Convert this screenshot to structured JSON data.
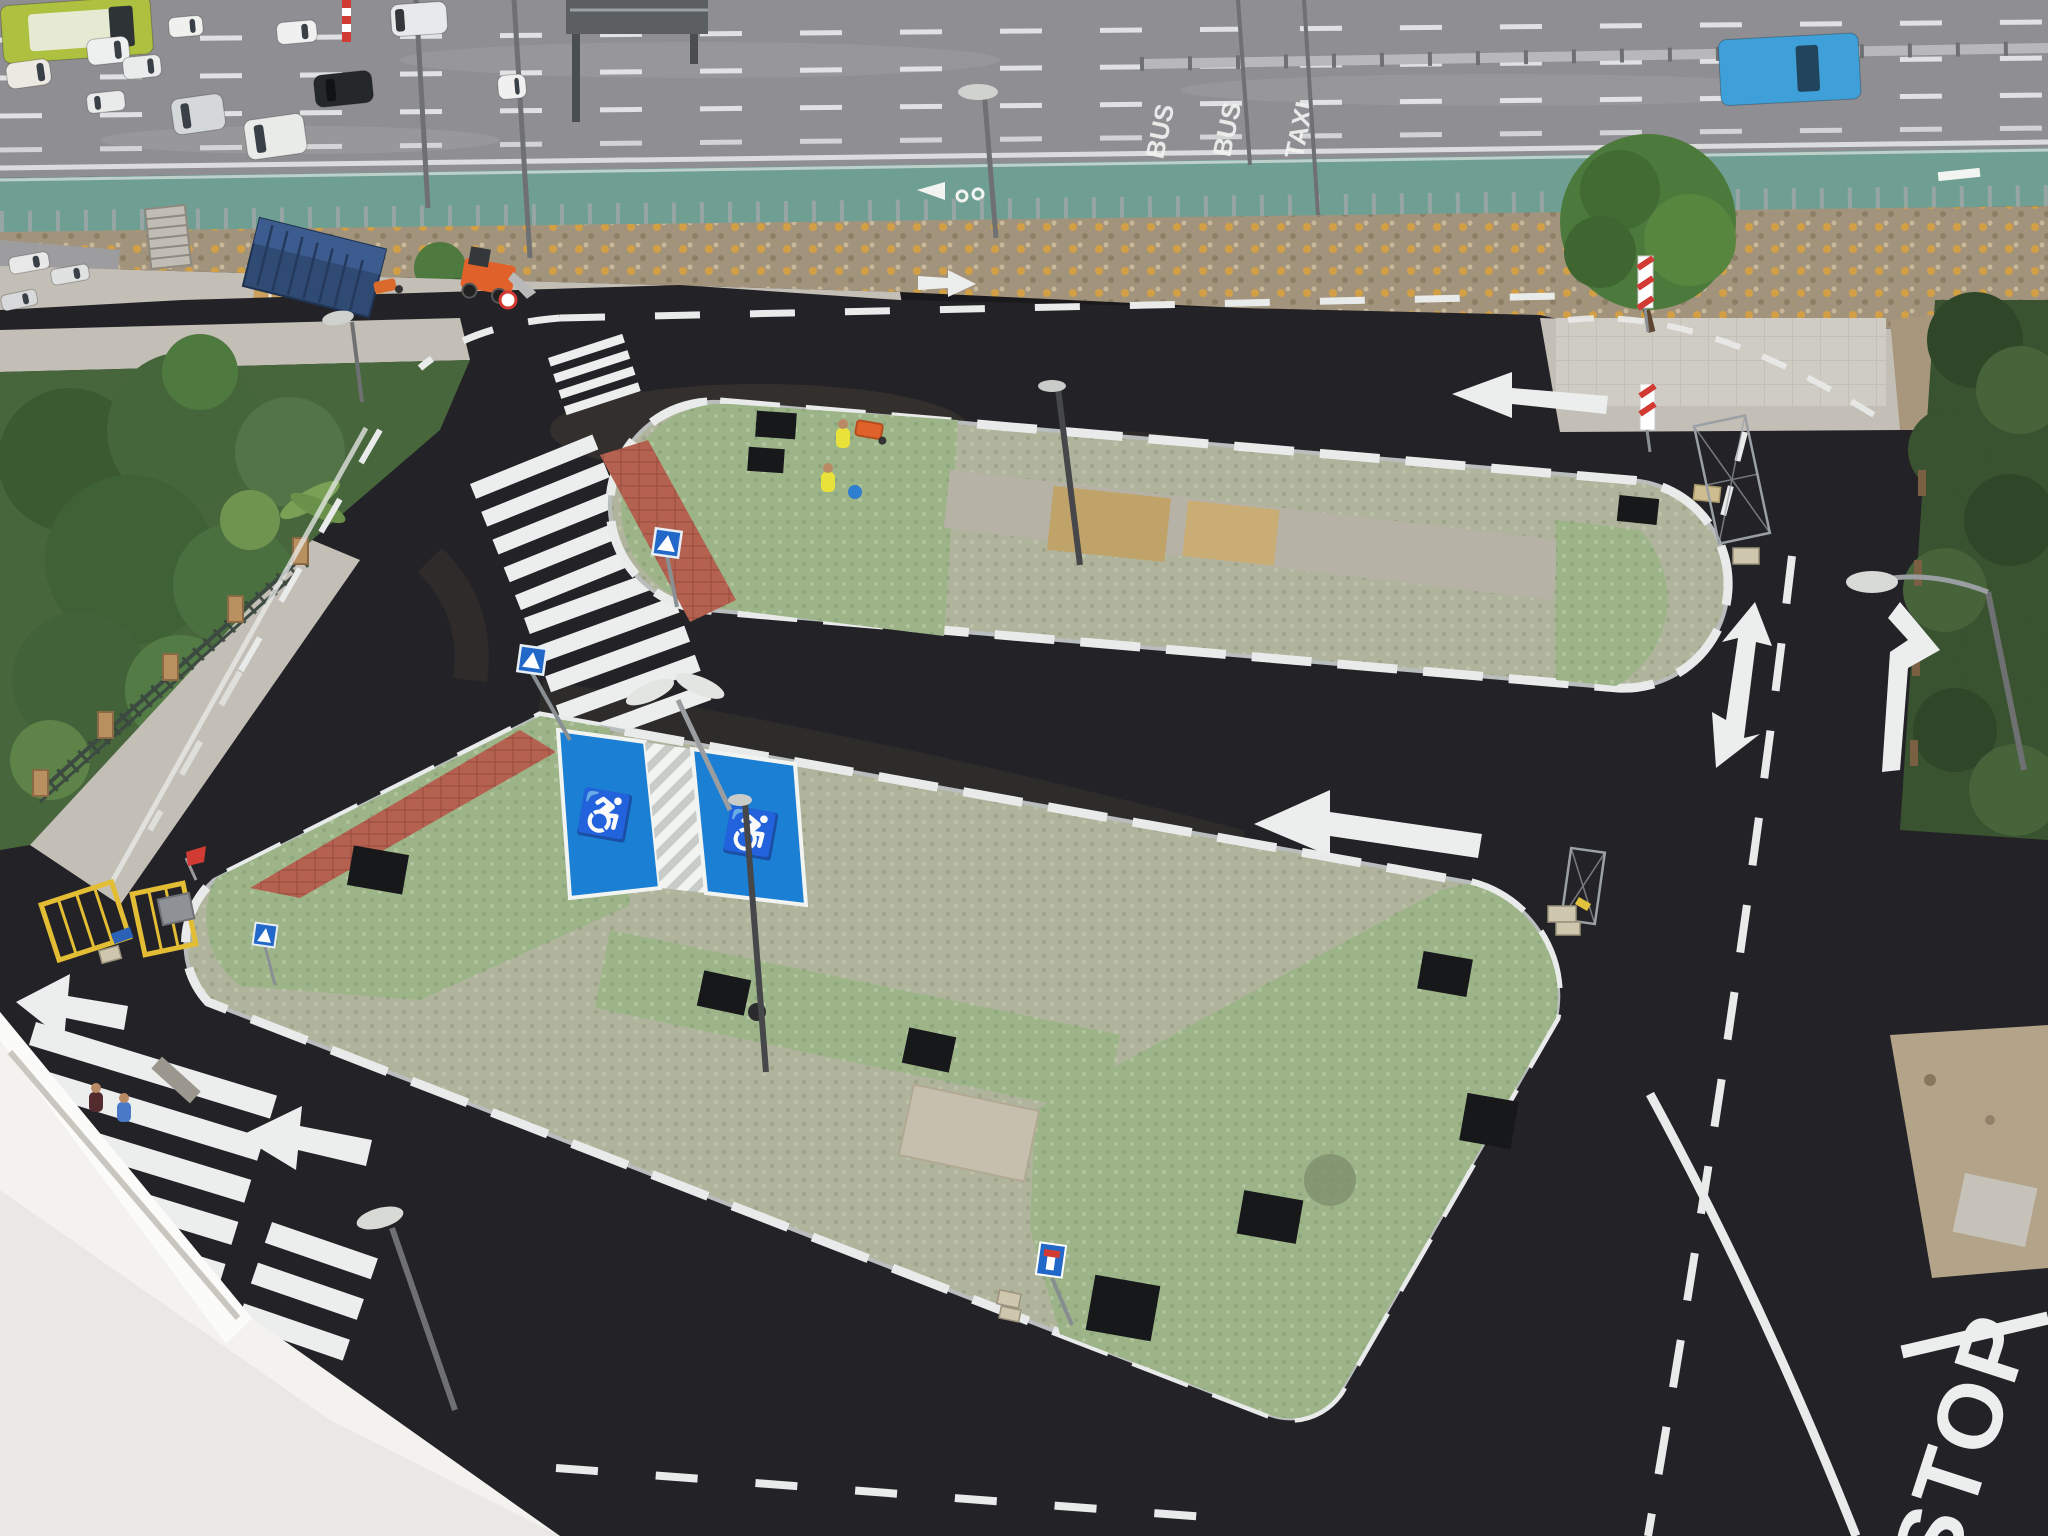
{
  "scene": {
    "setting": "aerial view of a newly paved parking area with two landscaped parking islands beside a multi-lane highway",
    "conditions": "daytime, overcast"
  },
  "road_paint_text": {
    "bus_1": "BUS",
    "bus_2": "BUS",
    "taxi": "TAXI",
    "stop": "STOP"
  },
  "icons": {
    "wheelchair": "♿"
  },
  "colors": {
    "highway": "#8f8f93",
    "bike_lane": "#6f9f92",
    "wall": "#a2937c",
    "sidewalk": "#c3bfb6",
    "concrete_old": "#b7b3aa",
    "asphalt": "#232327",
    "island_paver": "#b0b49c",
    "island_green": "#9db489",
    "spine_concrete": "#b7b2a6",
    "tan_panel": "#bfa368",
    "red_tile": "#b4614f",
    "pit_black": "#17181a",
    "curb_white": "#e9ebea",
    "handicap_blue": "#1b7fd4",
    "sign_blue": "#2268c8",
    "red_sign": "#d13b34",
    "garden_lawn": "#47663c",
    "hedge": "#39522f",
    "building": "#f3f2ef",
    "container": "#2f4a73",
    "machine_orange": "#e0622a",
    "barrier_yellow": "#e3bd34",
    "dirt": "#b3a489",
    "vest_hivis": "#e8e23a"
  },
  "vehicles": [
    {
      "name": "bus-green",
      "x": 0,
      "y": 6,
      "w": 150,
      "h": 58,
      "a": -4,
      "body": "#aec03f",
      "glass": "#2e3436",
      "win": 0.72,
      "roof": "#e6ead2"
    },
    {
      "name": "van-white-yellow-stripe",
      "x": 5,
      "y": 64,
      "w": 44,
      "h": 26,
      "a": -8,
      "body": "#ece9e2",
      "win": 0.7
    },
    {
      "name": "car-white-1",
      "x": 86,
      "y": 40,
      "w": 42,
      "h": 26,
      "a": -6,
      "body": "#eef0f0",
      "win": 0.65
    },
    {
      "name": "car-white-2",
      "x": 168,
      "y": 18,
      "w": 34,
      "h": 20,
      "a": -5,
      "body": "#f0f0ee",
      "win": 0.62
    },
    {
      "name": "car-white-3",
      "x": 276,
      "y": 23,
      "w": 40,
      "h": 22,
      "a": -5,
      "body": "#eff0ef",
      "win": 0.62
    },
    {
      "name": "car-white-4",
      "x": 122,
      "y": 58,
      "w": 38,
      "h": 22,
      "a": -6,
      "body": "#eaecec",
      "win": 0.65
    },
    {
      "name": "car-white-5",
      "x": 86,
      "y": 94,
      "w": 38,
      "h": 20,
      "a": -6,
      "body": "#e9eaea",
      "win": 0.2
    },
    {
      "name": "van-silver",
      "x": 170,
      "y": 100,
      "w": 52,
      "h": 36,
      "a": -8,
      "body": "#d5d8d9",
      "win": 0.18
    },
    {
      "name": "kombi-white",
      "x": 243,
      "y": 121,
      "w": 60,
      "h": 40,
      "a": -8,
      "body": "#e9ebe9",
      "win": 0.16
    },
    {
      "name": "suv-black",
      "x": 313,
      "y": 76,
      "w": 58,
      "h": 32,
      "a": -6,
      "body": "#25282b",
      "glass": "#101214",
      "win": 0.2
    },
    {
      "name": "truck-white",
      "x": 390,
      "y": 5,
      "w": 56,
      "h": 32,
      "a": -4,
      "body": "#e7e9ea",
      "glass": "#34383c",
      "win": 0.08
    },
    {
      "name": "car-white-6",
      "x": 497,
      "y": 76,
      "w": 28,
      "h": 24,
      "a": -5,
      "body": "#f0f0f0",
      "win": 0.6
    },
    {
      "name": "car-blue-hatchback",
      "x": 1718,
      "y": 40,
      "w": 140,
      "h": 66,
      "a": -3,
      "body": "#3f9fd8",
      "glass": "#20455c",
      "win": 0.55
    },
    {
      "name": "parked-car-1",
      "x": 8,
      "y": 258,
      "w": 40,
      "h": 17,
      "a": -10,
      "body": "#e8e8e8",
      "win": 0.6
    },
    {
      "name": "parked-car-2",
      "x": 50,
      "y": 270,
      "w": 38,
      "h": 16,
      "a": -10,
      "body": "#e0e1e1",
      "win": 0.6
    },
    {
      "name": "parked-car-3",
      "x": 0,
      "y": 296,
      "w": 36,
      "h": 16,
      "a": -12,
      "body": "#d8d9da",
      "win": 0.6
    }
  ],
  "people": [
    {
      "name": "worker-hivis-1",
      "x": 843,
      "y": 426,
      "top": "#e8e23a"
    },
    {
      "name": "worker-hivis-2",
      "x": 828,
      "y": 470,
      "top": "#e8e23a"
    },
    {
      "name": "pedestrian-1",
      "x": 96,
      "y": 1090,
      "top": "#532b2f"
    },
    {
      "name": "pedestrian-2",
      "x": 124,
      "y": 1100,
      "top": "#4a79c8"
    }
  ]
}
